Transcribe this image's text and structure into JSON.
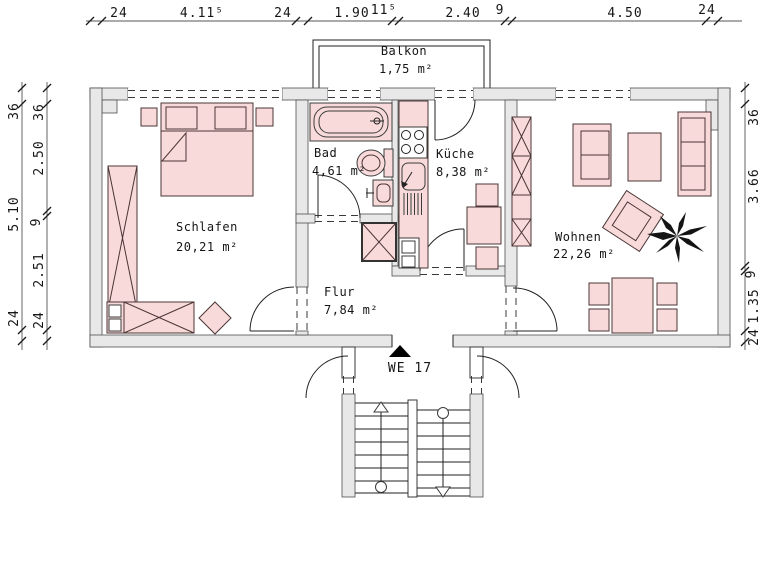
{
  "rooms": {
    "balkon": {
      "name": "Balkon",
      "area": "1,75 m²"
    },
    "schlafen": {
      "name": "Schlafen",
      "area": "20,21 m²"
    },
    "bad": {
      "name": "Bad",
      "area": "4,61 m²"
    },
    "kueche": {
      "name": "Küche",
      "area": "8,38 m²"
    },
    "wohnen": {
      "name": "Wohnen",
      "area": "22,26 m²"
    },
    "flur": {
      "name": "Flur",
      "area": "7,84 m²"
    }
  },
  "entrance": {
    "label": "WE 17"
  },
  "dims": {
    "top": [
      "24",
      "4.11⁵",
      "24",
      "1.90",
      "11⁵",
      "2.40",
      "9",
      "4.50",
      "24"
    ],
    "left_outer": [
      "36",
      "5.10",
      "24"
    ],
    "left_inner": [
      "36",
      "2.50",
      "9",
      "2.51",
      "24"
    ],
    "right": [
      "36",
      "3.66",
      "9",
      "1.35",
      "24"
    ]
  },
  "colors": {
    "wall_fill": "#e8e8e8",
    "furniture_fill": "#f9dada",
    "furniture_stroke": "#4a3535",
    "line": "#222222"
  }
}
